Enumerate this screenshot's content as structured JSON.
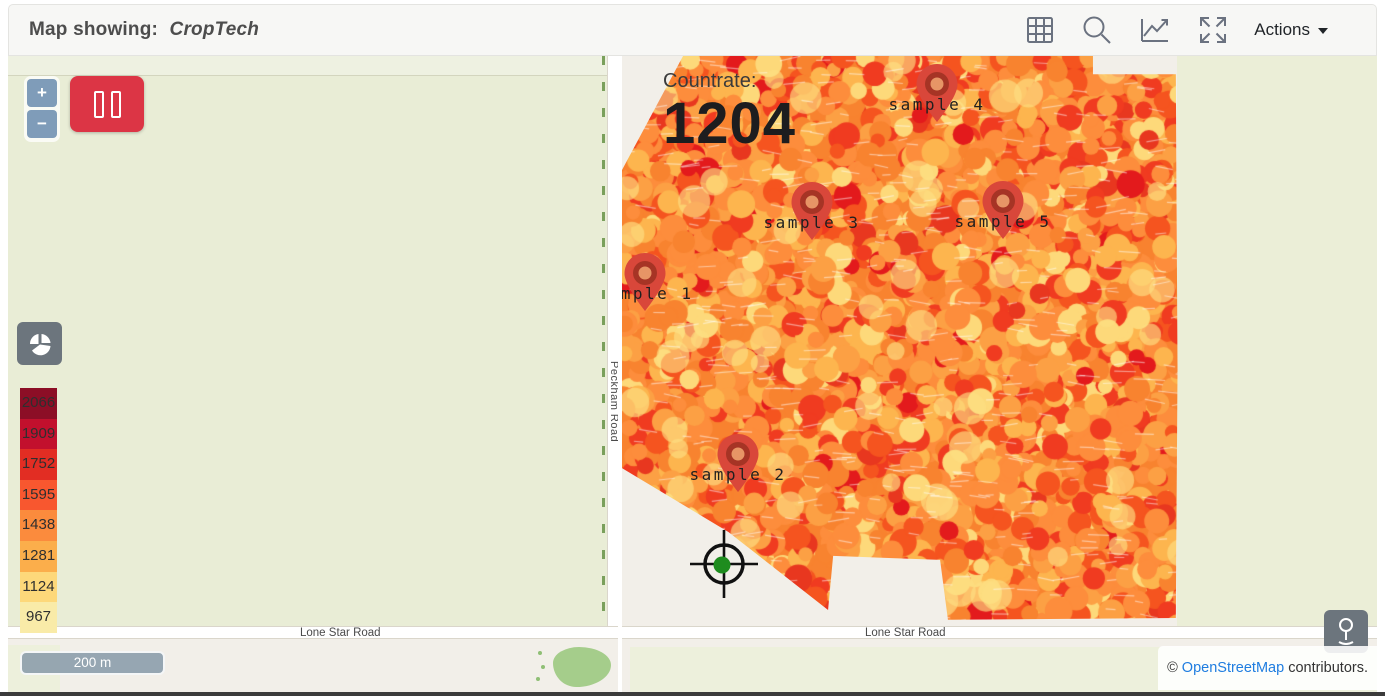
{
  "header": {
    "title_prefix": "Map showing:",
    "map_name": "CropTech",
    "actions_label": "Actions"
  },
  "toolbar_icons": [
    "grid-icon",
    "search-icon",
    "line-chart-icon",
    "fullscreen-icon"
  ],
  "map_controls": {
    "zoom_in_label": "+",
    "zoom_out_label": "−",
    "scale_bar_label": "200 m"
  },
  "status": {
    "countrate_label": "Countrate:",
    "countrate_value": "1204"
  },
  "legend": {
    "entries": [
      {
        "value": "2066",
        "color": "#8c0e26"
      },
      {
        "value": "1909",
        "color": "#c2102d"
      },
      {
        "value": "1752",
        "color": "#e22d23"
      },
      {
        "value": "1595",
        "color": "#f8572f"
      },
      {
        "value": "1438",
        "color": "#fb8b3d"
      },
      {
        "value": "1281",
        "color": "#fbae4b"
      },
      {
        "value": "1124",
        "color": "#fdd87a"
      },
      {
        "value": "967",
        "color": "#f9eba8"
      }
    ]
  },
  "samples": [
    {
      "label": "sample 1",
      "x": 23,
      "y": 218
    },
    {
      "label": "sample 2",
      "x": 116,
      "y": 399
    },
    {
      "label": "sample 3",
      "x": 190,
      "y": 147
    },
    {
      "label": "sample 4",
      "x": 315,
      "y": 29
    },
    {
      "label": "sample 5",
      "x": 381,
      "y": 146
    }
  ],
  "roads": {
    "vertical_label": "Peckham Road",
    "horizontal_label_left": "Lone Star Road",
    "horizontal_label_right": "Lone Star Road"
  },
  "attribution": {
    "prefix": "© ",
    "link_text": "OpenStreetMap",
    "suffix": " contributors."
  },
  "heatmap": {
    "base_color": "#f8822f",
    "palette": [
      {
        "color": "#fd8d3c",
        "w": 0.24
      },
      {
        "color": "#f8832f",
        "w": 0.17
      },
      {
        "color": "#fca044",
        "w": 0.13
      },
      {
        "color": "#f5541f",
        "w": 0.12
      },
      {
        "color": "#f03b20",
        "w": 0.1
      },
      {
        "color": "#fdb54e",
        "w": 0.12
      },
      {
        "color": "#fdd97a",
        "w": 0.07
      },
      {
        "color": "#e8371f",
        "w": 0.03
      },
      {
        "color": "#e31a1c",
        "w": 0.02
      }
    ],
    "streak_color": "rgba(255,255,255,0.5)"
  },
  "marker_colors": {
    "body": "#d9473a",
    "ring": "#a63425",
    "hole": "rgba(238,160,110,0.9)"
  },
  "crosshair_color": {
    "ring": "#111111",
    "dot": "#1e8c1e"
  },
  "ui_colors": {
    "accent_red": "#dc3545",
    "control_gray": "#6c757d",
    "zoom_blue": "#7f9cb9",
    "field_green": "#e9edd6",
    "land_beige": "#f2efe9",
    "link_blue": "#1f7de0"
  }
}
